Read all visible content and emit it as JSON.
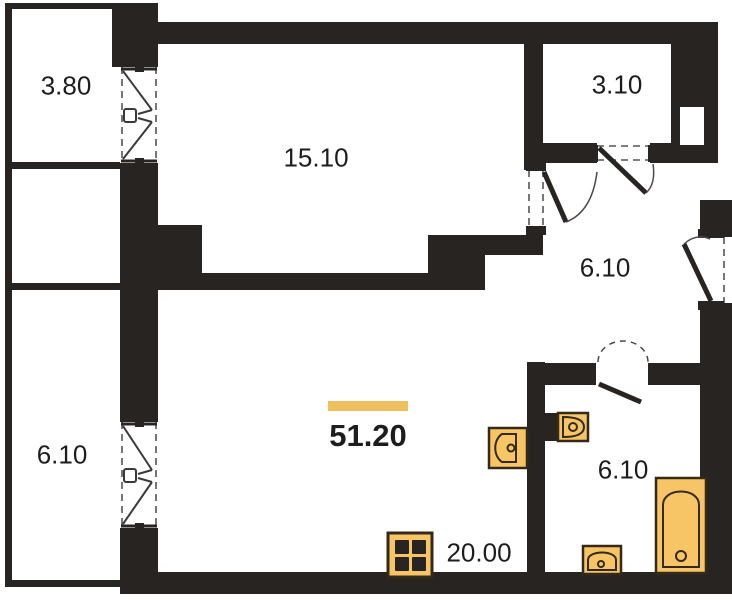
{
  "title": "apartment floor plan",
  "rooms": {
    "balcony_top": "3.80",
    "living": "15.10",
    "storage": "3.10",
    "hallway": "6.10",
    "bathroom": "6.10",
    "balcony_bottom": "6.10",
    "kitchen_living": "20.00"
  },
  "total_area": "51.20",
  "fixtures": [
    "kitchen-sink",
    "toilet",
    "bathroom-sink",
    "bathtub",
    "stove"
  ],
  "colors": {
    "wall": "#282422",
    "fixture_fill": "#f7c566",
    "fixture_stroke": "#342a19",
    "highlight": "#efbe5e",
    "text": "#1d1d1d"
  }
}
